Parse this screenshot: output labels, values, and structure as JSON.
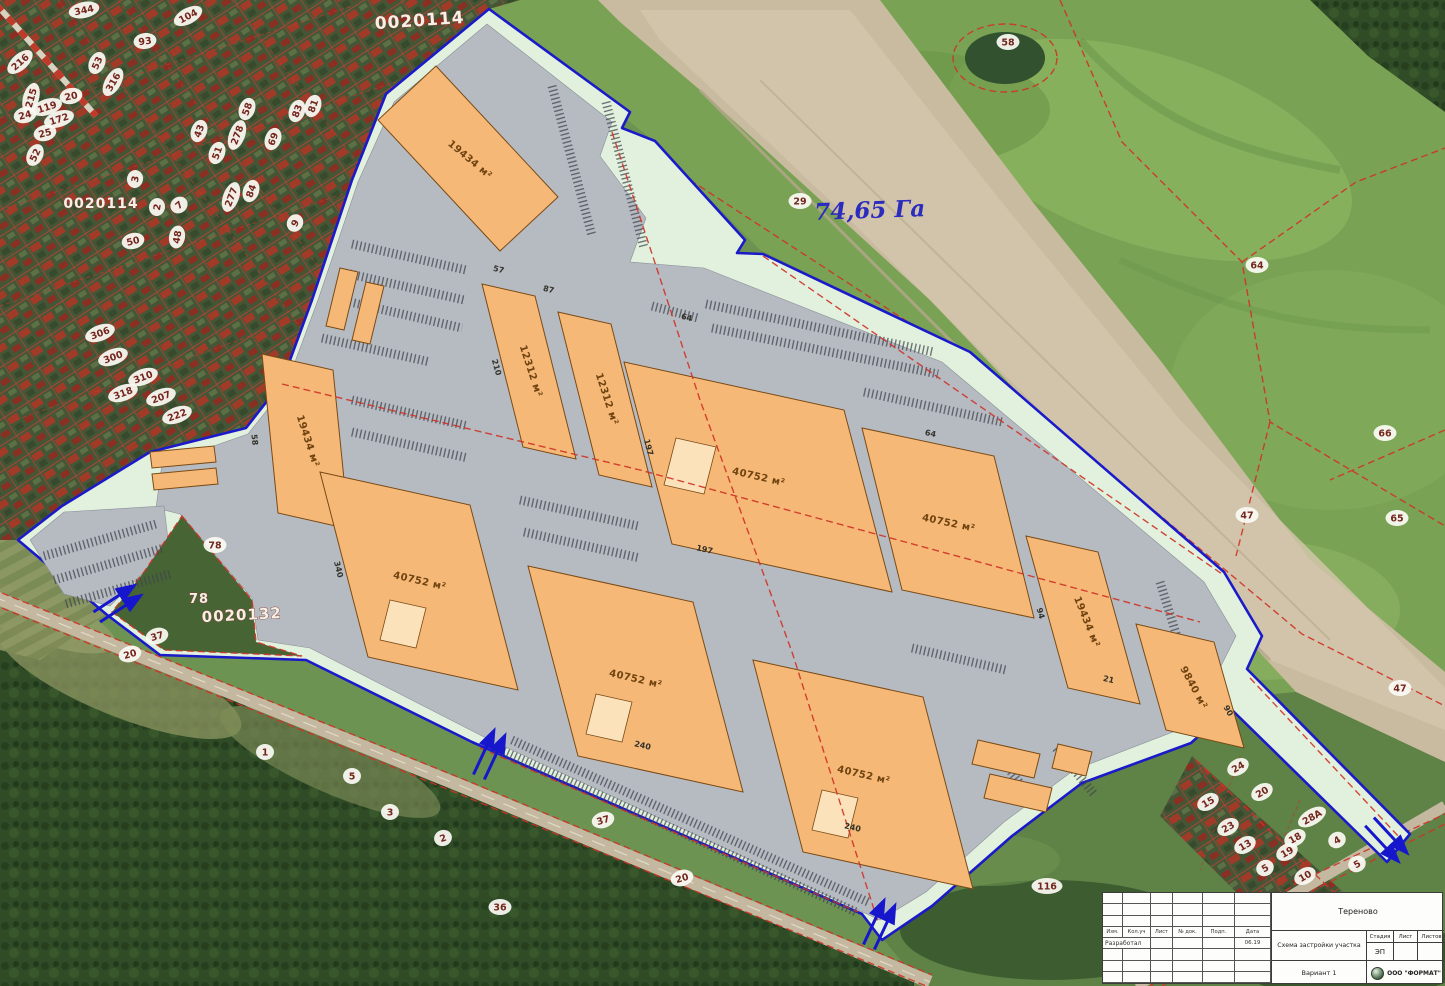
{
  "map": {
    "area_label": "74,65 Га",
    "cadastral": [
      {
        "t": "0020114",
        "x": 420,
        "y": 26,
        "s": 17,
        "r": -4
      },
      {
        "t": "0020114",
        "x": 101,
        "y": 208,
        "s": 14,
        "r": 0
      },
      {
        "t": "78",
        "x": 199,
        "y": 603,
        "s": 13,
        "r": 0
      },
      {
        "t": "0020132",
        "x": 242,
        "y": 620,
        "s": 15,
        "r": -3
      }
    ],
    "buildings": [
      {
        "area": "19434 м²"
      },
      {
        "area": "19434 м²"
      },
      {
        "area": "12312 м²"
      },
      {
        "area": "12312 м²"
      },
      {
        "area": "40752 м²"
      },
      {
        "area": "40752 м²"
      },
      {
        "area": "40752 м²"
      },
      {
        "area": "40752 м²"
      },
      {
        "area": "40752 м²"
      },
      {
        "area": "19434 м²"
      },
      {
        "area": "9840 м²"
      }
    ],
    "dims": [
      {
        "t": "210",
        "x": 494,
        "y": 368,
        "r": 74
      },
      {
        "t": "87",
        "x": 548,
        "y": 292,
        "r": 14
      },
      {
        "t": "57",
        "x": 498,
        "y": 272,
        "r": 14
      },
      {
        "t": "64",
        "x": 686,
        "y": 320,
        "r": 14
      },
      {
        "t": "64",
        "x": 930,
        "y": 436,
        "r": 12
      },
      {
        "t": "197",
        "x": 646,
        "y": 448,
        "r": 75
      },
      {
        "t": "197",
        "x": 704,
        "y": 552,
        "r": 13
      },
      {
        "t": "240",
        "x": 642,
        "y": 748,
        "r": 13
      },
      {
        "t": "240",
        "x": 852,
        "y": 830,
        "r": 13
      },
      {
        "t": "340",
        "x": 336,
        "y": 570,
        "r": 76
      },
      {
        "t": "94",
        "x": 1038,
        "y": 614,
        "r": 74
      },
      {
        "t": "58",
        "x": 252,
        "y": 440,
        "r": 84
      },
      {
        "t": "21",
        "x": 1108,
        "y": 682,
        "r": 13
      },
      {
        "t": "90",
        "x": 1226,
        "y": 712,
        "r": 60
      }
    ],
    "ovals": [
      {
        "t": "216",
        "x": 20,
        "y": 62,
        "r": -42
      },
      {
        "t": "344",
        "x": 84,
        "y": 10,
        "r": -12
      },
      {
        "t": "104",
        "x": 188,
        "y": 16,
        "r": -28
      },
      {
        "t": "93",
        "x": 145,
        "y": 41,
        "r": -8
      },
      {
        "t": "53",
        "x": 97,
        "y": 63,
        "r": -66
      },
      {
        "t": "316",
        "x": 113,
        "y": 82,
        "r": -60
      },
      {
        "t": "215",
        "x": 31,
        "y": 98,
        "r": -74
      },
      {
        "t": "20",
        "x": 71,
        "y": 96,
        "r": -12
      },
      {
        "t": "119",
        "x": 47,
        "y": 107,
        "r": -18
      },
      {
        "t": "172",
        "x": 59,
        "y": 119,
        "r": -18
      },
      {
        "t": "24",
        "x": 25,
        "y": 115,
        "r": -14
      },
      {
        "t": "25",
        "x": 45,
        "y": 133,
        "r": -14
      },
      {
        "t": "52",
        "x": 35,
        "y": 155,
        "r": -64
      },
      {
        "t": "43",
        "x": 199,
        "y": 131,
        "r": -70
      },
      {
        "t": "58",
        "x": 247,
        "y": 109,
        "r": -70
      },
      {
        "t": "278",
        "x": 237,
        "y": 135,
        "r": -70
      },
      {
        "t": "69",
        "x": 273,
        "y": 139,
        "r": -70
      },
      {
        "t": "83",
        "x": 297,
        "y": 111,
        "r": -70
      },
      {
        "t": "81",
        "x": 313,
        "y": 106,
        "r": -70
      },
      {
        "t": "51",
        "x": 217,
        "y": 153,
        "r": -70
      },
      {
        "t": "84",
        "x": 251,
        "y": 191,
        "r": -70
      },
      {
        "t": "277",
        "x": 231,
        "y": 197,
        "r": -70
      },
      {
        "t": "3",
        "x": 135,
        "y": 179,
        "r": -80
      },
      {
        "t": "2",
        "x": 157,
        "y": 207,
        "r": -80
      },
      {
        "t": "7",
        "x": 179,
        "y": 205,
        "r": -40
      },
      {
        "t": "50",
        "x": 133,
        "y": 241,
        "r": -14
      },
      {
        "t": "48",
        "x": 177,
        "y": 237,
        "r": -80
      },
      {
        "t": "9",
        "x": 295,
        "y": 223,
        "r": -60
      },
      {
        "t": "306",
        "x": 100,
        "y": 333,
        "r": -20
      },
      {
        "t": "300",
        "x": 113,
        "y": 357,
        "r": -20
      },
      {
        "t": "310",
        "x": 143,
        "y": 377,
        "r": -20
      },
      {
        "t": "318",
        "x": 123,
        "y": 393,
        "r": -20
      },
      {
        "t": "207",
        "x": 161,
        "y": 397,
        "r": -20
      },
      {
        "t": "222",
        "x": 177,
        "y": 415,
        "r": -20
      },
      {
        "t": "58",
        "x": 1008,
        "y": 42,
        "r": 0
      },
      {
        "t": "64",
        "x": 1257,
        "y": 265,
        "r": 0
      },
      {
        "t": "66",
        "x": 1385,
        "y": 433,
        "r": 0
      },
      {
        "t": "47",
        "x": 1247,
        "y": 515,
        "r": 0
      },
      {
        "t": "65",
        "x": 1397,
        "y": 518,
        "r": 0
      },
      {
        "t": "47",
        "x": 1400,
        "y": 688,
        "r": 0
      },
      {
        "t": "29",
        "x": 800,
        "y": 201,
        "r": 0
      },
      {
        "t": "78",
        "x": 215,
        "y": 545,
        "r": 0
      },
      {
        "t": "37",
        "x": 157,
        "y": 636,
        "r": -16
      },
      {
        "t": "20",
        "x": 130,
        "y": 654,
        "r": -16
      },
      {
        "t": "1",
        "x": 265,
        "y": 752,
        "r": 0
      },
      {
        "t": "5",
        "x": 352,
        "y": 776,
        "r": 0
      },
      {
        "t": "3",
        "x": 390,
        "y": 812,
        "r": 0
      },
      {
        "t": "2",
        "x": 443,
        "y": 838,
        "r": -18
      },
      {
        "t": "37",
        "x": 603,
        "y": 820,
        "r": -16
      },
      {
        "t": "20",
        "x": 682,
        "y": 878,
        "r": -16
      },
      {
        "t": "36",
        "x": 500,
        "y": 907,
        "r": 0
      },
      {
        "t": "116",
        "x": 1047,
        "y": 886,
        "r": 0
      },
      {
        "t": "24",
        "x": 1238,
        "y": 767,
        "r": -30
      },
      {
        "t": "20",
        "x": 1262,
        "y": 792,
        "r": -30
      },
      {
        "t": "15",
        "x": 1208,
        "y": 802,
        "r": -30
      },
      {
        "t": "23",
        "x": 1228,
        "y": 827,
        "r": -30
      },
      {
        "t": "28А",
        "x": 1312,
        "y": 817,
        "r": -30
      },
      {
        "t": "13",
        "x": 1245,
        "y": 845,
        "r": -30
      },
      {
        "t": "18",
        "x": 1295,
        "y": 838,
        "r": -30
      },
      {
        "t": "19",
        "x": 1287,
        "y": 852,
        "r": -30
      },
      {
        "t": "5",
        "x": 1265,
        "y": 868,
        "r": -30
      },
      {
        "t": "4",
        "x": 1337,
        "y": 840,
        "r": -30
      },
      {
        "t": "5",
        "x": 1357,
        "y": 864,
        "r": -30
      },
      {
        "t": "10",
        "x": 1305,
        "y": 876,
        "r": -30
      }
    ]
  },
  "titleblock": {
    "project": "Тереново",
    "title": "Схема застройки участка",
    "variant": "Вариант 1",
    "company": "ООО \"ФОРМАТ\"",
    "stage_label": "Стадия",
    "sheet_label": "Лист",
    "sheets_label": "Листов",
    "stage": "ЭП",
    "developed": "Разработал",
    "date": "06.19",
    "cols": [
      "Изм.",
      "Кол.уч",
      "Лист",
      "№ док.",
      "Подп.",
      "Дата"
    ]
  }
}
